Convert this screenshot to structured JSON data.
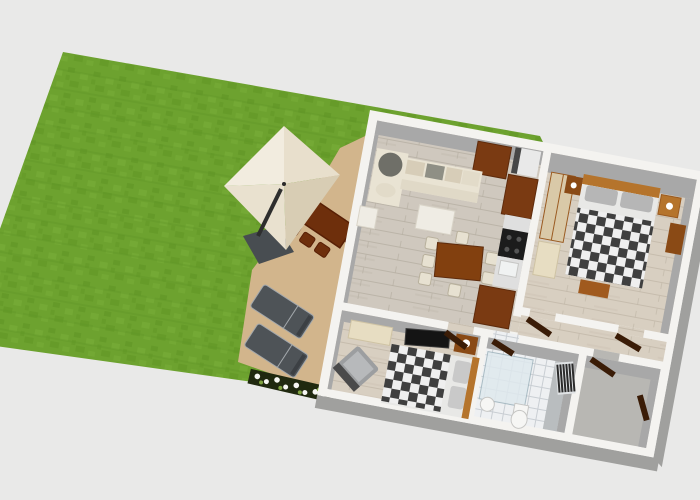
{
  "scene": {
    "title": "3D aerial floor plan render with garden and terrace",
    "background_color": "#e9e9e8"
  },
  "inventory": {
    "outdoor_areas": [
      "lawn",
      "terrace"
    ],
    "outdoor_objects": [
      "parasol",
      "parasol-base",
      "outdoor-dining-table",
      "outdoor-chair",
      "sun-lounger",
      "sun-lounger",
      "flower-planter"
    ],
    "rooms": [
      "living-kitchen-dining",
      "master-bedroom",
      "hallway",
      "second-bedroom",
      "bathroom",
      "utility-room"
    ],
    "furniture": [
      "corner-sofa",
      "coffee-table",
      "side-table",
      "tall-cabinet",
      "dining-table",
      "dining-chair",
      "fridge",
      "kitchen-counter",
      "stove",
      "sink",
      "kitchen-cabinet",
      "wardrobe",
      "double-bed-checkered",
      "nightstand-with-lamp",
      "dresser",
      "bed-chest",
      "single-bed-checkered",
      "wall-tv",
      "armchair",
      "cream-dresser",
      "shower",
      "toilet",
      "washbasin",
      "radiator",
      "open-door"
    ]
  },
  "counts": {
    "sun_loungers": 2,
    "indoor_dining_chairs": 7,
    "outdoor_chairs": 5,
    "checkered_beds": 2,
    "open_doors": 6
  },
  "colors": {
    "background": "#e9e9e8",
    "lawn": "#6da22f",
    "lawn_dark": "#5f9424",
    "lawn_light": "#79ae3a",
    "terrace": "#d2b58c",
    "planter": "#20290f",
    "flower": "#f6f6f2",
    "leaf": "#7fa23f",
    "parasol_n": "#f2ecdf",
    "parasol_e": "#e8dfcc",
    "parasol_s": "#d8cdb4",
    "parasol_w": "#e9e1cf",
    "parasol_dot": "#2a2a2a",
    "pole": "#2e2e2e",
    "parasol_base": "#484d51",
    "lounger": "#4e5357",
    "lounger_dark": "#3c4044",
    "lounger_frame": "#a3a8ac",
    "out_table": "#6e2f0c",
    "out_table_dark": "#571f05",
    "wall": "#f4f3f0",
    "wall_face": "#a8a8a8",
    "wall_side": "#a0a09e",
    "floor": "#cfc8be",
    "floor_line": "#b7afa3",
    "floor_warm": "#d8cfc1",
    "floor_warm_line": "#c2b8a8",
    "concrete": "#b8b7b3",
    "checker_dark": "#3f3f3f",
    "checker_light": "#efefef",
    "bath_tile": "#eef0f2",
    "bath_tile_line": "#c9ced3",
    "bath_gray": "#b9bdbf",
    "glass": "#dfe9ee",
    "glass_edge": "#9fb4bd",
    "white_obj": "#f6f6f4",
    "fixture_line": "#c6c6c4",
    "sofa": "#e9e3d3",
    "sofa_seat": "#e0d9c7",
    "cushion_tan": "#d7cdb8",
    "cushion_gray": "#8f8f85",
    "cushion_dark": "#6f6f68",
    "cushion_pale": "#e2dbc9",
    "table_white": "#efece4",
    "table_edge": "#d9d4c8",
    "chair": "#e7e1d1",
    "chair_edge": "#b8b09c",
    "din_table": "#82400f",
    "cab_brown": "#7a3a12",
    "cab_brown_dark": "#5e2b0c",
    "bed_frame": "#b5742c",
    "bed_frame_dark": "#9a5a20",
    "chest": "#a05a1e",
    "wardrobe_tan": "#d9c9a8",
    "dresser_cream": "#e7ddc2",
    "dresser_edge": "#cfc3a4",
    "pillow": "#b6b6b6",
    "pillow_light": "#c9c9c9",
    "sheet": "#e8e8e6",
    "nightstand": "#8a4a15",
    "lamp": "#ffffff",
    "tv": "#141414",
    "tv_edge": "#3a3a3a",
    "stove": "#1c1c1c",
    "burner": "#555555",
    "fridge": "#e9e9e9",
    "fridge_dark": "#474747",
    "counter": "#dfdfdf",
    "sink": "#f0f2f2",
    "armchair": "#9c9ea0",
    "armchair_dark": "#4a4a4a",
    "armchair_seat": "#b7b9bb",
    "radiator": "#e0e3e5",
    "radiator_fin": "#2b2b2b",
    "door": "#3a1c07"
  }
}
